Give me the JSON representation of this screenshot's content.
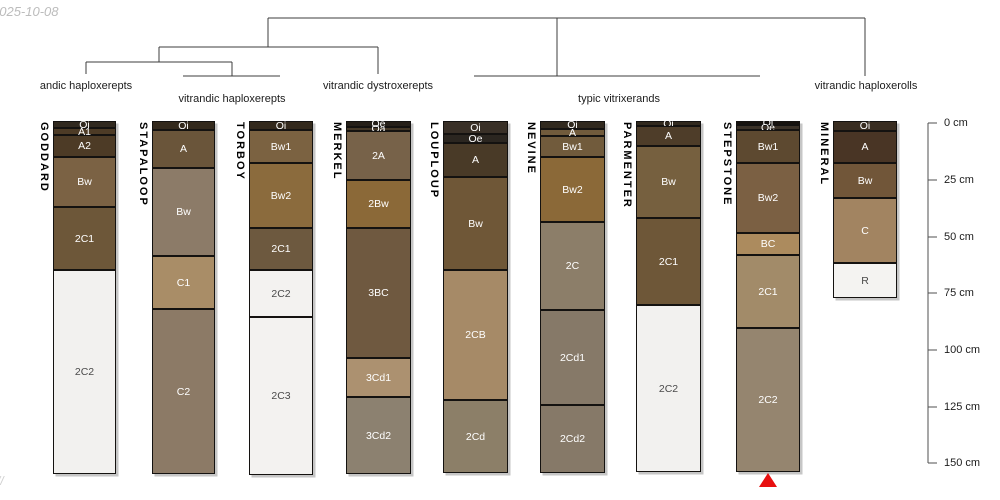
{
  "chart_data": {
    "type": "other",
    "description": "Dendrogram of soil taxonomic groups above sketches of soil profiles (pedons) with named horizons, plotted against a depth axis in cm",
    "watermark_top_left": "2025-10-08",
    "watermark_bottom_left": "//",
    "dendrogram": {
      "line_color": "#3c3c3c",
      "segments": [
        [
          268,
          18,
          865,
          18
        ],
        [
          268,
          18,
          268,
          47
        ],
        [
          159,
          47,
          378,
          47
        ],
        [
          159,
          47,
          159,
          62
        ],
        [
          86,
          62,
          232,
          62
        ],
        [
          86,
          62,
          86,
          74
        ],
        [
          232,
          62,
          232,
          76
        ],
        [
          183,
          76,
          280,
          76
        ],
        [
          378,
          47,
          378,
          74
        ],
        [
          557,
          18,
          557,
          76
        ],
        [
          474,
          76,
          760,
          76
        ],
        [
          865,
          18,
          865,
          76
        ]
      ],
      "cluster_labels": [
        {
          "label": "andic haploxerepts",
          "x": 86,
          "y": 80,
          "members": [
            "GODDARD"
          ]
        },
        {
          "label": "vitrandic haploxerepts",
          "x": 232,
          "y": 93,
          "members": [
            "STAPALOOP",
            "TORBOY"
          ]
        },
        {
          "label": "vitrandic dystroxerepts",
          "x": 378,
          "y": 80,
          "members": [
            "MERKEL"
          ]
        },
        {
          "label": "typic vitrixerands",
          "x": 619,
          "y": 93,
          "members": [
            "LOUPLOUP",
            "NEVINE",
            "PARMENTER",
            "STEPSTONE"
          ]
        },
        {
          "label": "vitrandic haploxerolls",
          "x": 866,
          "y": 80,
          "members": [
            "MINERAL"
          ]
        }
      ]
    },
    "depth_axis": {
      "x": 928,
      "top": 123,
      "bottom": 463,
      "tick_length": 9,
      "unit": "cm",
      "line_color": "#4f4f4f",
      "label_color": "#1c1c1c",
      "ticks": [
        {
          "label": "0 cm",
          "depth_cm": 0,
          "y": 123
        },
        {
          "label": "25 cm",
          "depth_cm": 25,
          "y": 180
        },
        {
          "label": "50 cm",
          "depth_cm": 50,
          "y": 237
        },
        {
          "label": "75 cm",
          "depth_cm": 75,
          "y": 293
        },
        {
          "label": "100 cm",
          "depth_cm": 100,
          "y": 350
        },
        {
          "label": "125 cm",
          "depth_cm": 125,
          "y": 407
        },
        {
          "label": "150 cm",
          "depth_cm": 150,
          "y": 463
        }
      ]
    },
    "profiles": [
      {
        "name": "GODDARD",
        "x": 53,
        "width": 63,
        "horizons": [
          {
            "name": "Oi",
            "y": [
              121,
              128
            ],
            "cm": [
              0,
              2
            ],
            "fill": "#31291f",
            "text": "#ffffff"
          },
          {
            "name": "A1",
            "y": [
              128,
              135
            ],
            "cm": [
              2,
              5
            ],
            "fill": "#4d3b26",
            "text": "#ffffff"
          },
          {
            "name": "A2",
            "y": [
              135,
              157
            ],
            "cm": [
              5,
              15
            ],
            "fill": "#4d3b26",
            "text": "#ffffff"
          },
          {
            "name": "Bw",
            "y": [
              157,
              207
            ],
            "cm": [
              15,
              37
            ],
            "fill": "#7b6244",
            "text": "#ffffff"
          },
          {
            "name": "2C1",
            "y": [
              207,
              270
            ],
            "cm": [
              37,
              65
            ],
            "fill": "#6d5739",
            "text": "#ffffff"
          },
          {
            "name": "2C2",
            "y": [
              270,
              474
            ],
            "cm": [
              65,
              155
            ],
            "fill": "#f2f1ef",
            "text": "#4a4a4a"
          }
        ]
      },
      {
        "name": "STAPALOOP",
        "x": 152,
        "width": 63,
        "horizons": [
          {
            "name": "Oi",
            "y": [
              121,
              130
            ],
            "cm": [
              0,
              3
            ],
            "fill": "#33291c",
            "text": "#ffffff"
          },
          {
            "name": "A",
            "y": [
              130,
              168
            ],
            "cm": [
              3,
              20
            ],
            "fill": "#6a553a",
            "text": "#ffffff"
          },
          {
            "name": "Bw",
            "y": [
              168,
              256
            ],
            "cm": [
              20,
              59
            ],
            "fill": "#8c7b68",
            "text": "#ffffff"
          },
          {
            "name": "C1",
            "y": [
              256,
              309
            ],
            "cm": [
              59,
              82
            ],
            "fill": "#a98d67",
            "text": "#ffffff"
          },
          {
            "name": "C2",
            "y": [
              309,
              474
            ],
            "cm": [
              82,
              155
            ],
            "fill": "#8c7a66",
            "text": "#ffffff"
          }
        ]
      },
      {
        "name": "TORBOY",
        "x": 249,
        "width": 64,
        "horizons": [
          {
            "name": "Oi",
            "y": [
              121,
              130
            ],
            "cm": [
              0,
              3
            ],
            "fill": "#33291c",
            "text": "#ffffff"
          },
          {
            "name": "Bw1",
            "y": [
              130,
              163
            ],
            "cm": [
              3,
              18
            ],
            "fill": "#7b6241",
            "text": "#ffffff"
          },
          {
            "name": "Bw2",
            "y": [
              163,
              228
            ],
            "cm": [
              18,
              46
            ],
            "fill": "#8b6b3d",
            "text": "#ffffff"
          },
          {
            "name": "2C1",
            "y": [
              228,
              270
            ],
            "cm": [
              46,
              65
            ],
            "fill": "#6d593f",
            "text": "#ffffff"
          },
          {
            "name": "2C2",
            "y": [
              270,
              317
            ],
            "cm": [
              65,
              86
            ],
            "fill": "#f3f2f0",
            "text": "#4a4a4a"
          },
          {
            "name": "2C3",
            "y": [
              317,
              475
            ],
            "cm": [
              86,
              155
            ],
            "fill": "#f3f2f0",
            "text": "#4a4a4a"
          }
        ]
      },
      {
        "name": "MERKEL",
        "x": 346,
        "width": 65,
        "horizons": [
          {
            "name": "Oe",
            "y": [
              121,
              127
            ],
            "cm": [
              0,
              2
            ],
            "fill": "#262019",
            "text": "#ffffff"
          },
          {
            "name": "Oa",
            "y": [
              127,
              131
            ],
            "cm": [
              2,
              4
            ],
            "fill": "#453827",
            "text": "#ffffff"
          },
          {
            "name": "2A",
            "y": [
              131,
              180
            ],
            "cm": [
              4,
              25
            ],
            "fill": "#776249",
            "text": "#ffffff"
          },
          {
            "name": "2Bw",
            "y": [
              180,
              228
            ],
            "cm": [
              25,
              46
            ],
            "fill": "#8b6938",
            "text": "#ffffff"
          },
          {
            "name": "3BC",
            "y": [
              228,
              358
            ],
            "cm": [
              46,
              104
            ],
            "fill": "#6f5940",
            "text": "#ffffff"
          },
          {
            "name": "3Cd1",
            "y": [
              358,
              397
            ],
            "cm": [
              104,
              121
            ],
            "fill": "#ac9170",
            "text": "#ffffff"
          },
          {
            "name": "3Cd2",
            "y": [
              397,
              474
            ],
            "cm": [
              121,
              155
            ],
            "fill": "#8c8170",
            "text": "#ffffff"
          }
        ]
      },
      {
        "name": "LOUPLOUP",
        "x": 443,
        "width": 65,
        "horizons": [
          {
            "name": "Oi",
            "y": [
              121,
              134
            ],
            "cm": [
              0,
              5
            ],
            "fill": "#393027",
            "text": "#ffffff"
          },
          {
            "name": "Oe",
            "y": [
              134,
              143
            ],
            "cm": [
              5,
              9
            ],
            "fill": "#2b2620",
            "text": "#ffffff"
          },
          {
            "name": "A",
            "y": [
              143,
              177
            ],
            "cm": [
              9,
              24
            ],
            "fill": "#493a27",
            "text": "#ffffff"
          },
          {
            "name": "Bw",
            "y": [
              177,
              270
            ],
            "cm": [
              24,
              65
            ],
            "fill": "#6f5737",
            "text": "#ffffff"
          },
          {
            "name": "2CB",
            "y": [
              270,
              400
            ],
            "cm": [
              65,
              122
            ],
            "fill": "#a68a67",
            "text": "#ffffff"
          },
          {
            "name": "2Cd",
            "y": [
              400,
              473
            ],
            "cm": [
              122,
              154
            ],
            "fill": "#8c7f68",
            "text": "#ffffff"
          }
        ]
      },
      {
        "name": "NEVINE",
        "x": 540,
        "width": 65,
        "horizons": [
          {
            "name": "Oi",
            "y": [
              121,
              129
            ],
            "cm": [
              0,
              3
            ],
            "fill": "#31291e",
            "text": "#ffffff"
          },
          {
            "name": "A",
            "y": [
              129,
              136
            ],
            "cm": [
              3,
              6
            ],
            "fill": "#715b3c",
            "text": "#ffffff"
          },
          {
            "name": "Bw1",
            "y": [
              136,
              157
            ],
            "cm": [
              6,
              15
            ],
            "fill": "#715b3c",
            "text": "#ffffff"
          },
          {
            "name": "Bw2",
            "y": [
              157,
              222
            ],
            "cm": [
              15,
              44
            ],
            "fill": "#8b6938",
            "text": "#ffffff"
          },
          {
            "name": "2C",
            "y": [
              222,
              310
            ],
            "cm": [
              44,
              82
            ],
            "fill": "#8c7e69",
            "text": "#ffffff"
          },
          {
            "name": "2Cd1",
            "y": [
              310,
              405
            ],
            "cm": [
              82,
              124
            ],
            "fill": "#867968",
            "text": "#ffffff"
          },
          {
            "name": "2Cd2",
            "y": [
              405,
              473
            ],
            "cm": [
              124,
              154
            ],
            "fill": "#867968",
            "text": "#ffffff"
          }
        ]
      },
      {
        "name": "PARMENTER",
        "x": 636,
        "width": 65,
        "horizons": [
          {
            "name": "Oi",
            "y": [
              121,
              126
            ],
            "cm": [
              0,
              1
            ],
            "fill": "#31291e",
            "text": "#ffffff"
          },
          {
            "name": "A",
            "y": [
              126,
              146
            ],
            "cm": [
              1,
              10
            ],
            "fill": "#4e3d29",
            "text": "#ffffff"
          },
          {
            "name": "Bw",
            "y": [
              146,
              218
            ],
            "cm": [
              10,
              42
            ],
            "fill": "#76603f",
            "text": "#ffffff"
          },
          {
            "name": "2C1",
            "y": [
              218,
              305
            ],
            "cm": [
              42,
              80
            ],
            "fill": "#6e5738",
            "text": "#ffffff"
          },
          {
            "name": "2C2",
            "y": [
              305,
              472
            ],
            "cm": [
              80,
              154
            ],
            "fill": "#f2f1ef",
            "text": "#4a4a4a"
          }
        ]
      },
      {
        "name": "STEPSTONE",
        "x": 736,
        "width": 64,
        "marker": {
          "shape": "triangle-up",
          "color": "#e81010"
        },
        "horizons": [
          {
            "name": "Oi",
            "y": [
              121,
              125
            ],
            "cm": [
              0,
              1
            ],
            "fill": "#16120e",
            "text": "#ffffff"
          },
          {
            "name": "Oe",
            "y": [
              125,
              130
            ],
            "cm": [
              1,
              3
            ],
            "fill": "#3a3127",
            "text": "#ffffff"
          },
          {
            "name": "Bw1",
            "y": [
              130,
              163
            ],
            "cm": [
              3,
              18
            ],
            "fill": "#5d4930",
            "text": "#ffffff"
          },
          {
            "name": "Bw2",
            "y": [
              163,
              233
            ],
            "cm": [
              18,
              49
            ],
            "fill": "#7b6043",
            "text": "#ffffff"
          },
          {
            "name": "BC",
            "y": [
              233,
              255
            ],
            "cm": [
              49,
              58
            ],
            "fill": "#ac8b5e",
            "text": "#ffffff"
          },
          {
            "name": "2C1",
            "y": [
              255,
              328
            ],
            "cm": [
              58,
              90
            ],
            "fill": "#a28b69",
            "text": "#ffffff"
          },
          {
            "name": "2C2",
            "y": [
              328,
              472
            ],
            "cm": [
              90,
              154
            ],
            "fill": "#95856f",
            "text": "#ffffff"
          }
        ]
      },
      {
        "name": "MINERAL",
        "x": 833,
        "width": 64,
        "horizons": [
          {
            "name": "Oi",
            "y": [
              121,
              131
            ],
            "cm": [
              0,
              4
            ],
            "fill": "#392d21",
            "text": "#ffffff"
          },
          {
            "name": "A",
            "y": [
              131,
              163
            ],
            "cm": [
              4,
              18
            ],
            "fill": "#493525",
            "text": "#ffffff"
          },
          {
            "name": "Bw",
            "y": [
              163,
              198
            ],
            "cm": [
              18,
              33
            ],
            "fill": "#715639",
            "text": "#ffffff"
          },
          {
            "name": "C",
            "y": [
              198,
              263
            ],
            "cm": [
              33,
              62
            ],
            "fill": "#a28461",
            "text": "#ffffff"
          },
          {
            "name": "R",
            "y": [
              263,
              298
            ],
            "cm": [
              62,
              77
            ],
            "fill": "#f4f3f1",
            "text": "#4a4a4a"
          }
        ]
      }
    ]
  }
}
